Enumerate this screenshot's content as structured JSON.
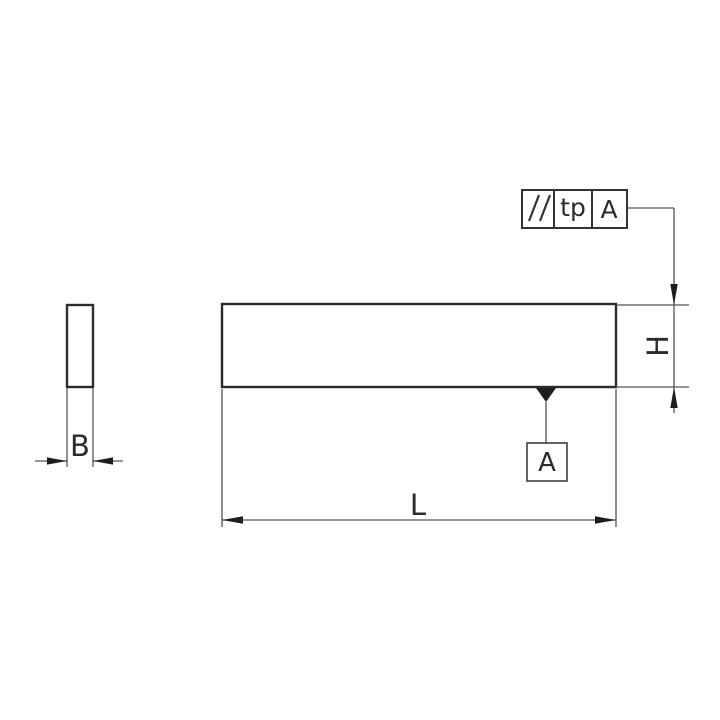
{
  "colors": {
    "background": "#ffffff",
    "outline": "#2b2b2b",
    "thin_line": "#555555",
    "text": "#2b2b2b",
    "arrow_fill": "#1e1e1e"
  },
  "drawing": {
    "views": {
      "side_view": {
        "description": "narrow vertical rectangle (end view of block)"
      },
      "front_view": {
        "description": "long horizontal rectangle (front view of block)"
      }
    },
    "dimensions": {
      "width_label": "B",
      "length_label": "L",
      "height_label": "H"
    },
    "gdt_frame": {
      "symbol_name": "parallelism",
      "symbol_glyph": "//",
      "tolerance_label": "tp",
      "datum_reference": "A"
    },
    "datum": {
      "label": "A"
    }
  }
}
